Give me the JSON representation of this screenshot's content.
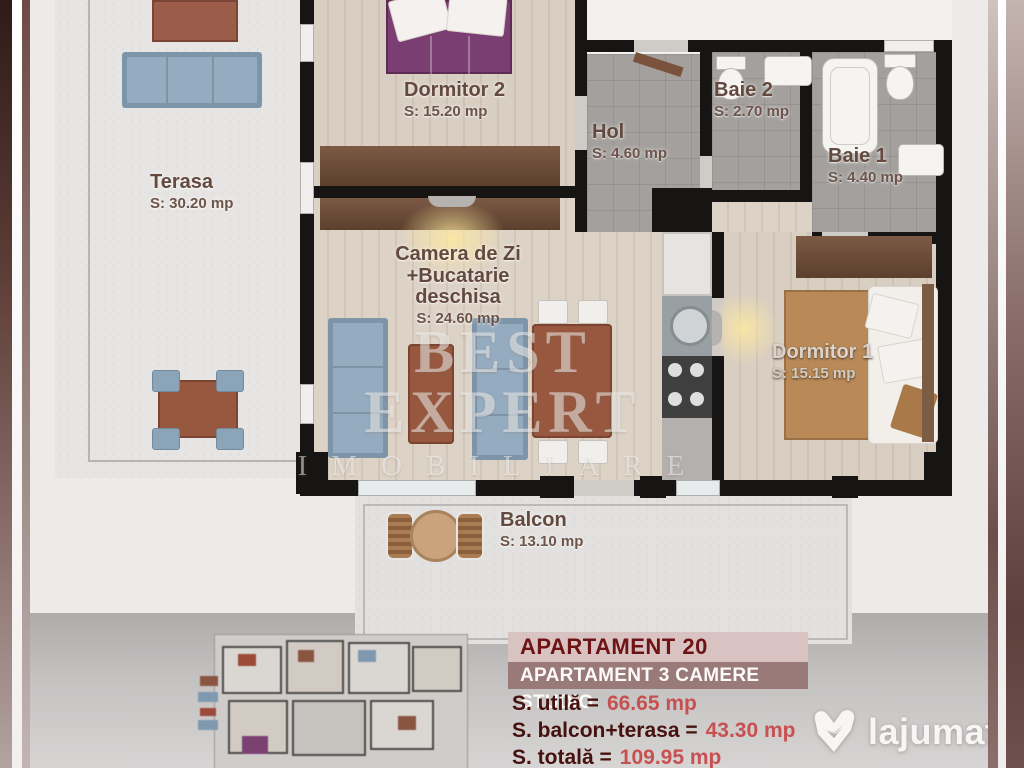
{
  "watermark": {
    "line1": "BEST EXPERT",
    "line2": "IMOBILIARE"
  },
  "rooms": {
    "terasa": {
      "name": "Terasa",
      "area": "S: 30.20 mp"
    },
    "dormitor2": {
      "name": "Dormitor 2",
      "area": "S: 15.20 mp"
    },
    "hol": {
      "name": "Hol",
      "area": "S: 4.60 mp"
    },
    "baie2": {
      "name": "Baie 2",
      "area": "S: 2.70 mp"
    },
    "baie1": {
      "name": "Baie 1",
      "area": "S: 4.40 mp"
    },
    "camera": {
      "name_line1": "Camera de Zi",
      "name_line2": "+Bucatarie",
      "name_line3": "deschisa",
      "area": "S: 24.60 mp"
    },
    "dormitor1": {
      "name": "Dormitor 1",
      "area": "S: 15.15 mp"
    },
    "balcon": {
      "name": "Balcon",
      "area": "S: 13.10 mp"
    }
  },
  "info_panel": {
    "title": "APARTAMENT 20",
    "subtitle": "APARTAMENT 3 CAMERE STUDIO",
    "stats": [
      {
        "label": "S. utilă =",
        "value": "66.65 mp"
      },
      {
        "label": "S. balcon+terasa =",
        "value": "43.30 mp"
      },
      {
        "label": "S. totală =",
        "value": "109.95 mp"
      }
    ]
  },
  "logo": {
    "text": "lajumate",
    "tld": ".ro"
  },
  "colors": {
    "panel_title_bg": "#d9c2c2",
    "panel_title_text": "#6d1414",
    "panel_subtitle_bg": "#9a7979",
    "stat_value_red": "#c75050",
    "logo_tld_green": "#8fd8c0",
    "bed_purple": "#7b3e72",
    "sofa_blue": "#95abbf",
    "wall_black": "#171513"
  }
}
